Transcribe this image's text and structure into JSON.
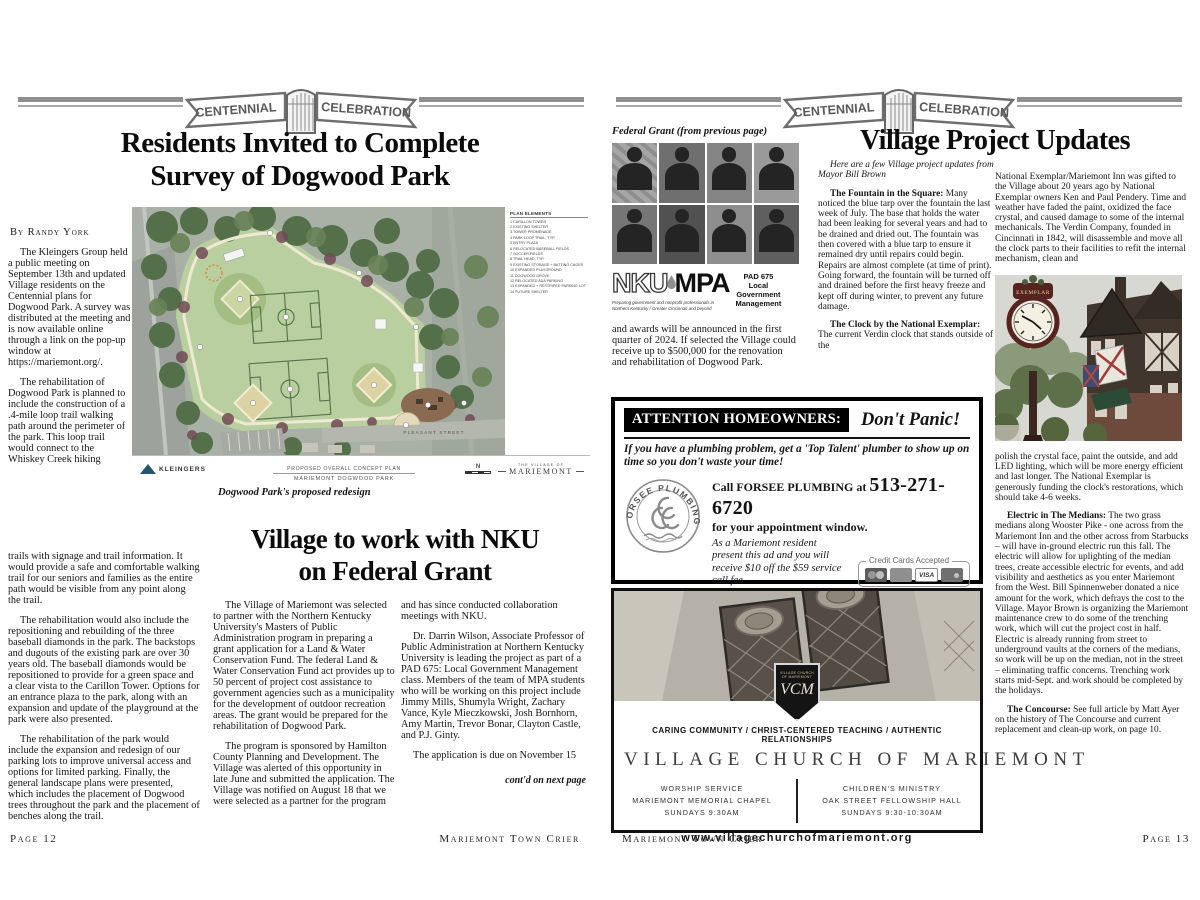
{
  "colors": {
    "ink": "#151515",
    "banner_gray": "#8f8f8f",
    "map_field_green": "#b9cfa0",
    "ad_black": "#000000"
  },
  "banner": {
    "word_left": "CENTENNIAL",
    "word_right": "CELEBRATION"
  },
  "left_page": {
    "headline_line1": "Residents Invited to Complete",
    "headline_line2": "Survey of Dogwood Park",
    "byline": "By Randy York",
    "narrow_paragraphs": [
      "The Kleingers Group held a public meeting on September 13th and updated Village residents on the Centennial plans for Dogwood Park. A survey was distributed at the meeting and is now available online through a link on the pop-up window at https://mariemont.org/.",
      "The rehabilitation of Dogwood Park is planned to include the construction of a .4-mile loop trail walking path around the perimeter of the park. This loop trail would connect to the Whiskey Creek hiking"
    ],
    "wide_p1": "trails with signage and trail information. It would provide a safe and comfortable walking trail for our seniors and families as the entire path would be visible from any point along the trail.",
    "wide_p2": "The rehabilitation would also include the repositioning and rebuilding of the three baseball diamonds in the park. The backstops and dugouts of the existing park are over 30 years old. The baseball diamonds would be repositioned to provide for a green space and a clear vista to the Carillon Tower. Options for an entrance plaza to the park, along with an expansion and update of the playground at the park were also presented.",
    "wide_p3": "The rehabilitation of the park would include the expansion and redesign of our parking lots to improve universal access and options for limited parking. Finally, the general landscape plans were presented, which includes the placement of Dogwood trees throughout the park and the placement of benches along the trail.",
    "map": {
      "legend_title": "PLAN ELEMENTS",
      "legend_items": [
        "1   CARILLON TOWER",
        "2   EXISTING SHELTER",
        "3   TOWER PROMENADE",
        "4   PARK LOOP TRAIL, TYP.",
        "5   ENTRY PLAZA",
        "6   RELOCATED BASEBALL FIELDS",
        "7   SOCCER FIELDS",
        "8   TRAIL HEAD, TYP.",
        "9   EXISTING STORAGE + BATTING CAGES",
        "10  EXPANDED PLAYGROUND",
        "11  DOGWOOD GROVE",
        "12  RELOCATED ADA PARKING",
        "13  EXPANDED + RESTRIPED PARKING LOT",
        "14  FUTURE SHELTER"
      ],
      "street_label": "PLEASANT STREET",
      "firm": "KLEINGERS",
      "plan_title1": "PROPOSED OVERALL CONCEPT PLAN",
      "plan_title2": "MARIEMONT DOGWOOD PARK",
      "north_label": "N",
      "village_line1": "THE VILLAGE OF",
      "village_line2": "MARIEMONT",
      "caption": "Dogwood Park's proposed redesign"
    },
    "nku_article": {
      "headline_line1": "Village to work with NKU",
      "headline_line2": "on Federal Grant",
      "col1_paragraphs": [
        "The Village of Mariemont was selected to partner with the Northern Kentucky University's Masters of Public Administration program in preparing a grant application for a Land & Water Conservation Fund. The federal Land & Water Conservation Fund act provides up to 50 percent of project cost assistance to government agencies such as a municipality for the development of outdoor recreation areas. The grant would be prepared for the rehabilitation of Dogwood Park.",
        "The program is sponsored by Hamilton County Planning and Development. The Village was alerted of this opportunity in late June and submitted the application. The Village was notified on August 18 that we were selected as a partner for the program"
      ],
      "col2_p1": "and has since conducted collaboration meetings with NKU.",
      "col2_p2": "Dr. Darrin Wilson, Associate Professor of Public Administration at Northern Kentucky University is leading the project as part of a PAD 675: Local Government Management class. Members of the team of MPA students who will be working on this project include Jimmy Mills, Shumyla Wright, Zachary Vance, Kyle Mieczkowski, Josh Bornhorn, Amy Martin, Trevor Bonar, Clayton Castle, and P.J. Ginty.",
      "col2_p3": "The application is due on November 15",
      "continued": "cont'd on next page"
    },
    "footer_left": "Page 12",
    "footer_right": "Mariemont Town Crier"
  },
  "right_page": {
    "headline": "Village Project Updates",
    "federal_grant_caption": "Federal Grant (from previous page)",
    "nku_logo": {
      "nku": "NKU",
      "mpa": "MPA",
      "tagline1": "Preparing government and nonprofit professionals in",
      "tagline2": "Northern Kentucky / Greater Cincinnati and beyond",
      "pad_lines": [
        "PAD 675",
        "Local",
        "Government",
        "Management"
      ]
    },
    "grant_paragraph": "and awards will be announced in the first quarter of 2024. If selected the Village could receive up to $500,000 for the renovation and rehabilitation of Dogwood Park.",
    "updates_intro": "Here are a few Village project updates from Mayor Bill Brown",
    "fountain": {
      "lead": "The Fountain in the Square:",
      "text": "  Many noticed the blue tarp over the fountain the last week of July. The base that holds the water had been leaking for several years and had to be drained and dried out. The fountain was then covered with a blue tarp to ensure it remained dry until repairs could begin. Repairs are almost complete (at time of print). Going forward, the fountain will be turned off and drained before the first heavy freeze and kept off during winter, to prevent any future damage."
    },
    "clock": {
      "lead": "The Clock by the National Exemplar:",
      "text": " The current Verdin clock that stands outside of the"
    },
    "col3_top": "National Exemplar/Mariemont Inn was gifted to the Village about 20 years ago by National Exemplar owners Ken and Paul Pendery. Time and weather have faded the paint, oxidized the face crystal, and caused damage to some of the internal mechanicals. The Verdin Company, founded in Cincinnati in 1842, will disassemble and move all the clock parts to their facilities to refit the internal mechanism, clean and",
    "clock_photo_label": "EXEMPLAR",
    "col3_after_photo": "polish the crystal face, paint the outside, and add LED lighting, which will be more energy efficient and last longer. The National Exemplar is generously funding the clock's restorations, which should take 4-6 weeks.",
    "electric": {
      "lead": "Electric in The Medians:",
      "text": " The two grass medians along Wooster Pike - one across from the Mariemont Inn and the other across from Starbucks – will have in-ground electric run this fall. The electric will allow for uplighting of the median trees, create accessible electric for events, and add visibility and aesthetics as you enter Mariemont from the West. Bill Spinnenweber donated a nice amount for the work, which defrays the cost to the Village. Mayor Brown is organizing the Mariemont maintenance crew to do some of the trenching work, which will cut the project cost in half. Electric is already running from street to underground vaults at the corners of the medians, so work will be up on the median, not in the street – eliminating traffic concerns. Trenching work starts mid-Sept. and work should be completed by the holidays."
    },
    "concourse": {
      "lead": "The Concourse:",
      "text": " See full article by Matt Ayer on the history of The Concourse and current replacement and clean-up work, on page 10."
    },
    "plumbing_ad": {
      "header_black": "ATTENTION HOMEOWNERS:",
      "header_italic": "Don't Panic!",
      "pitch": "If you have a plumbing problem,  get a 'Top Talent' plumber to show up on time so you don't waste your time!",
      "logo_name": "FORSEE PLUMBING",
      "call_pre": "Call FORSEE PLUMBING at",
      "phone": "513-271-6720",
      "call_post": "for your appointment window.",
      "offer": "As a Mariemont resident present this ad and you will receive $10 off the $59 service call fee.",
      "cards_label": "Credit Cards Accepted",
      "visa_label": "VISA",
      "president": "Robert Forsee Jr., President",
      "license": "OH License PL #16160 and KY License M7256"
    },
    "church_ad": {
      "crest_line1": "VILLAGE CHURCH",
      "crest_line2": "OF MARIEMONT",
      "crest_monogram": "VCM",
      "tagline": "CARING COMMUNITY / CHRIST-CENTERED TEACHING / AUTHENTIC RELATIONSHIPS",
      "name": "VILLAGE CHURCH OF MARIEMONT",
      "left_col": [
        "WORSHIP SERVICE",
        "MARIEMONT MEMORIAL CHAPEL",
        "SUNDAYS 9:30AM"
      ],
      "right_col": [
        "CHILDREN'S MINISTRY",
        "OAK STREET FELLOWSHIP HALL",
        "SUNDAYS 9:30-10:30AM"
      ],
      "website": "www.villagechurchofmariemont.org"
    },
    "footer_left": "Mariemont Town Crier",
    "footer_right": "Page 13"
  }
}
